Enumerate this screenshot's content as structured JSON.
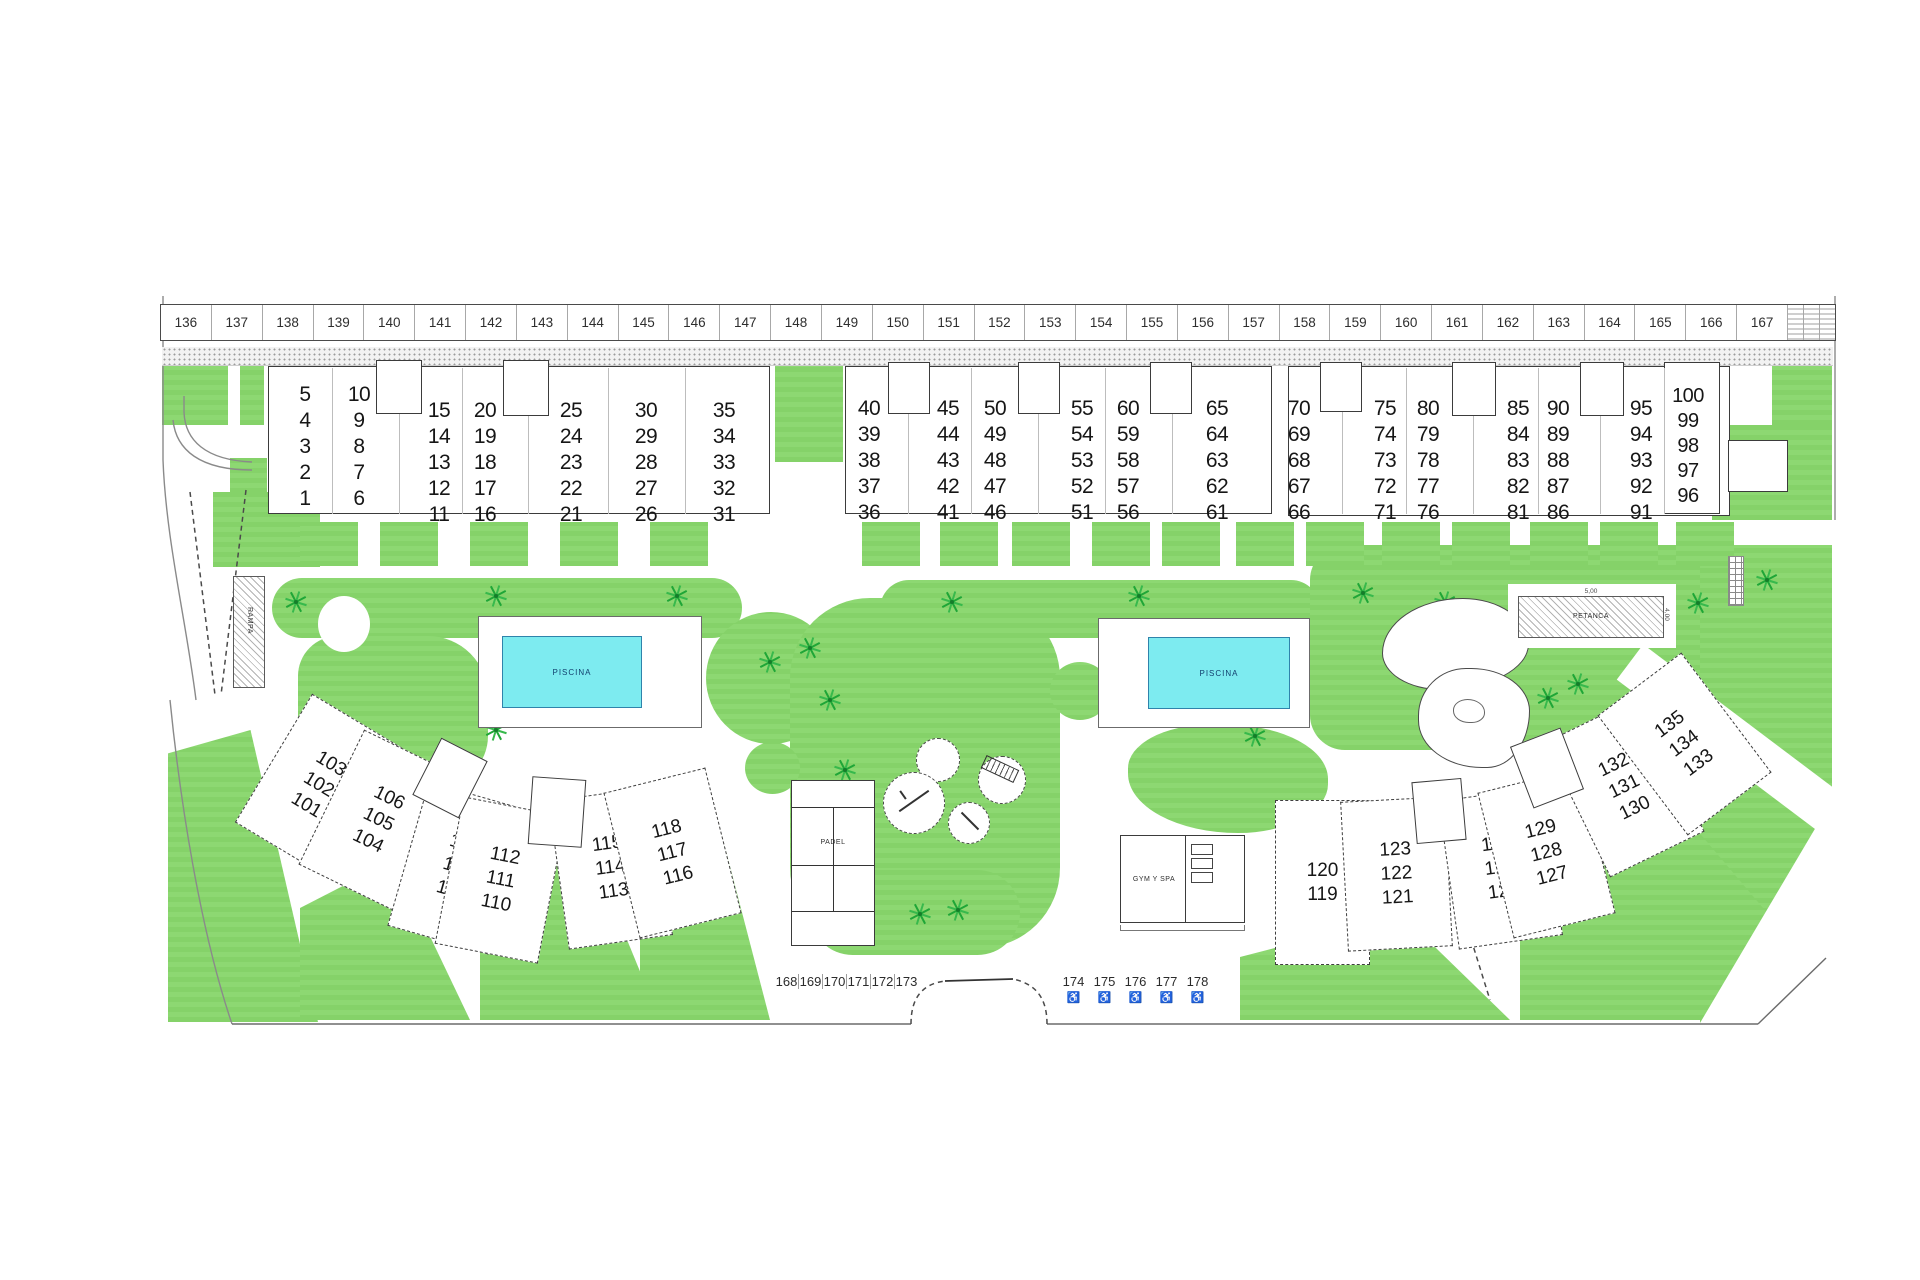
{
  "site": {
    "plan_name": "residential-site-plan",
    "parking_row_top": [
      "136",
      "137",
      "138",
      "139",
      "140",
      "141",
      "142",
      "143",
      "144",
      "145",
      "146",
      "147",
      "148",
      "149",
      "150",
      "151",
      "152",
      "153",
      "154",
      "155",
      "156",
      "157",
      "158",
      "159",
      "160",
      "161",
      "162",
      "163",
      "164",
      "165",
      "166",
      "167"
    ],
    "unit_blocks_top": [
      {
        "name": "block-a",
        "columns": [
          [
            "5",
            "4",
            "3",
            "2",
            "1"
          ],
          [
            "10",
            "9",
            "8",
            "7",
            "6"
          ],
          [
            "15",
            "14",
            "13",
            "12",
            "11"
          ],
          [
            "20",
            "19",
            "18",
            "17",
            "16"
          ],
          [
            "25",
            "24",
            "23",
            "22",
            "21"
          ],
          [
            "30",
            "29",
            "28",
            "27",
            "26"
          ],
          [
            "35",
            "34",
            "33",
            "32",
            "31"
          ]
        ]
      },
      {
        "name": "block-b",
        "columns": [
          [
            "40",
            "39",
            "38",
            "37",
            "36"
          ],
          [
            "45",
            "44",
            "43",
            "42",
            "41"
          ],
          [
            "50",
            "49",
            "48",
            "47",
            "46"
          ],
          [
            "55",
            "54",
            "53",
            "52",
            "51"
          ],
          [
            "60",
            "59",
            "58",
            "57",
            "56"
          ],
          [
            "65",
            "64",
            "63",
            "62",
            "61"
          ]
        ]
      },
      {
        "name": "block-c",
        "columns": [
          [
            "70",
            "69",
            "68",
            "67",
            "66"
          ],
          [
            "75",
            "74",
            "73",
            "72",
            "71"
          ],
          [
            "80",
            "79",
            "78",
            "77",
            "76"
          ],
          [
            "85",
            "84",
            "83",
            "82",
            "81"
          ],
          [
            "90",
            "89",
            "88",
            "87",
            "86"
          ],
          [
            "95",
            "94",
            "93",
            "92",
            "91"
          ],
          [
            "100",
            "99",
            "98",
            "97",
            "96"
          ]
        ]
      }
    ],
    "unit_blocks_bottom_left": [
      [
        "103",
        "102",
        "101"
      ],
      [
        "106",
        "105",
        "104"
      ],
      [
        "109",
        "108",
        "107"
      ],
      [
        "112",
        "111",
        "110"
      ],
      [
        "115",
        "114",
        "113"
      ],
      [
        "118",
        "117",
        "116"
      ]
    ],
    "unit_blocks_bottom_right": [
      [
        "120",
        "119"
      ],
      [
        "123",
        "122",
        "121"
      ],
      [
        "126",
        "125",
        "124"
      ],
      [
        "129",
        "128",
        "127"
      ],
      [
        "132",
        "131",
        "130"
      ],
      [
        "135",
        "134",
        "133"
      ]
    ],
    "pool_left_label": "PISCINA",
    "pool_right_label": "PISCINA",
    "petanca": {
      "label": "PETANCA",
      "width_dim": "5,00",
      "height_dim": "4,00"
    },
    "ramp_label": "RAMPA",
    "padel_label": "PADEL",
    "gym_label": "GYM Y SPA",
    "parking_row_bottom_left": [
      "168",
      "169",
      "170",
      "171",
      "172",
      "173"
    ],
    "parking_row_bottom_right": [
      "174",
      "175",
      "176",
      "177",
      "178"
    ],
    "wheelchair_icon": "♿",
    "colors": {
      "grass": "#86d46a",
      "tree": "#1fa637",
      "pool": "#7debf0",
      "outline": "#3b3b3b"
    }
  }
}
